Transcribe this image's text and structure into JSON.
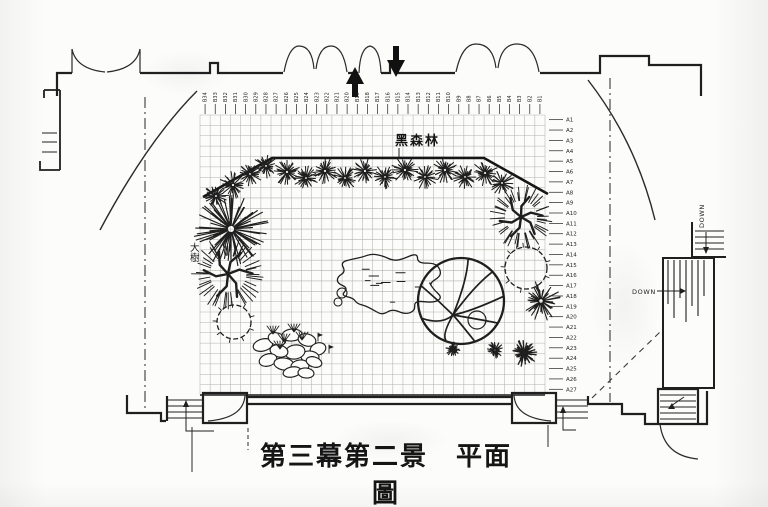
{
  "title": "第三幕第二景　平面圖",
  "labels": {
    "forest": "黑森林",
    "big_tree": "大樹",
    "down_stair_lower": "DOWN",
    "down_stair_upper": "DOWN"
  },
  "icons": {
    "stage-entry-up-arrow": "filled triangle arrow pointing up",
    "stage-entry-down-arrow": "filled triangle arrow pointing down",
    "stair-direction-arrows": "small leader arrows on staircases"
  },
  "colors": {
    "ink": "#1f1f1f",
    "grid": "#b3b2ab",
    "paper": "#fcfcfa"
  },
  "plan": {
    "grid": {
      "x": 200,
      "y": 115,
      "cols": 34,
      "rows": 27,
      "cw": 10.147,
      "ch": 10.37
    }
  },
  "ticks_top": [
    "B34",
    "B33",
    "B32",
    "B31",
    "B30",
    "B29",
    "B28",
    "B27",
    "B26",
    "B25",
    "B24",
    "B23",
    "B22",
    "B21",
    "B20",
    "B19",
    "B18",
    "B17",
    "B16",
    "B15",
    "B14",
    "B13",
    "B12",
    "B11",
    "B10",
    "B9",
    "B8",
    "B7",
    "B6",
    "B5",
    "B4",
    "B3",
    "B2",
    "B1"
  ],
  "ticks_right": [
    "A1",
    "A2",
    "A3",
    "A4",
    "A5",
    "A6",
    "A7",
    "A8",
    "A9",
    "A10",
    "A11",
    "A12",
    "A13",
    "A14",
    "A15",
    "A16",
    "A17",
    "A18",
    "A19",
    "A20",
    "A21",
    "A22",
    "A23",
    "A24",
    "A25",
    "A26",
    "A27"
  ],
  "plants": [
    {
      "t": "shrub",
      "x": 216,
      "y": 196,
      "r": 12
    },
    {
      "t": "shrub",
      "x": 233,
      "y": 185,
      "r": 13
    },
    {
      "t": "shrub",
      "x": 250,
      "y": 174,
      "r": 12
    },
    {
      "t": "shrub",
      "x": 266,
      "y": 166,
      "r": 12
    },
    {
      "t": "shrub",
      "x": 287,
      "y": 172,
      "r": 13
    },
    {
      "t": "shrub",
      "x": 306,
      "y": 178,
      "r": 12
    },
    {
      "t": "shrub",
      "x": 325,
      "y": 171,
      "r": 13
    },
    {
      "t": "shrub",
      "x": 345,
      "y": 178,
      "r": 12
    },
    {
      "t": "shrub",
      "x": 365,
      "y": 171,
      "r": 13
    },
    {
      "t": "shrub",
      "x": 385,
      "y": 177,
      "r": 12
    },
    {
      "t": "shrub",
      "x": 405,
      "y": 170,
      "r": 13
    },
    {
      "t": "shrub",
      "x": 425,
      "y": 177,
      "r": 12
    },
    {
      "t": "shrub",
      "x": 445,
      "y": 170,
      "r": 13
    },
    {
      "t": "shrub",
      "x": 465,
      "y": 177,
      "r": 12
    },
    {
      "t": "shrub",
      "x": 485,
      "y": 173,
      "r": 13
    },
    {
      "t": "shrub",
      "x": 502,
      "y": 183,
      "r": 12
    },
    {
      "t": "pine-large",
      "x": 231,
      "y": 229,
      "r": 36
    },
    {
      "t": "branch-tree",
      "x": 228,
      "y": 274,
      "r": 34
    },
    {
      "t": "branch-tree",
      "x": 521,
      "y": 217,
      "r": 30
    },
    {
      "t": "circle-bush",
      "x": 234,
      "y": 322,
      "r": 17
    },
    {
      "t": "circle-bush",
      "x": 526,
      "y": 268,
      "r": 21
    },
    {
      "t": "pine",
      "x": 541,
      "y": 301,
      "r": 19
    },
    {
      "t": "pine",
      "x": 495,
      "y": 350,
      "r": 8
    },
    {
      "t": "dark-scribble",
      "x": 524,
      "y": 353,
      "r": 13
    },
    {
      "t": "canopy-tree",
      "x": 461,
      "y": 301,
      "r": 43
    },
    {
      "t": "dot-blob",
      "x": 453,
      "y": 349,
      "r": 7
    },
    {
      "t": "rock-blob",
      "x": 388,
      "y": 283,
      "rx": 52,
      "ry": 31
    }
  ],
  "rock_pile": [
    [
      263,
      345,
      10,
      6,
      -15
    ],
    [
      277,
      339,
      9,
      6,
      20
    ],
    [
      292,
      335,
      10,
      6,
      -5
    ],
    [
      307,
      340,
      9,
      6,
      15
    ],
    [
      318,
      349,
      8,
      6,
      -20
    ],
    [
      310,
      357,
      9,
      6,
      5
    ],
    [
      295,
      352,
      10,
      7,
      -10
    ],
    [
      279,
      351,
      9,
      6,
      12
    ],
    [
      268,
      360,
      9,
      6,
      -18
    ],
    [
      284,
      364,
      10,
      6,
      8
    ],
    [
      300,
      366,
      9,
      6,
      -6
    ],
    [
      314,
      362,
      8,
      5,
      18
    ],
    [
      292,
      372,
      9,
      5,
      -12
    ],
    [
      306,
      373,
      8,
      5,
      6
    ]
  ],
  "grass": [
    [
      273,
      334
    ],
    [
      284,
      342
    ],
    [
      294,
      332
    ],
    [
      280,
      349
    ],
    [
      302,
      340
    ]
  ],
  "flags": [
    [
      318,
      341
    ],
    [
      329,
      353
    ]
  ]
}
